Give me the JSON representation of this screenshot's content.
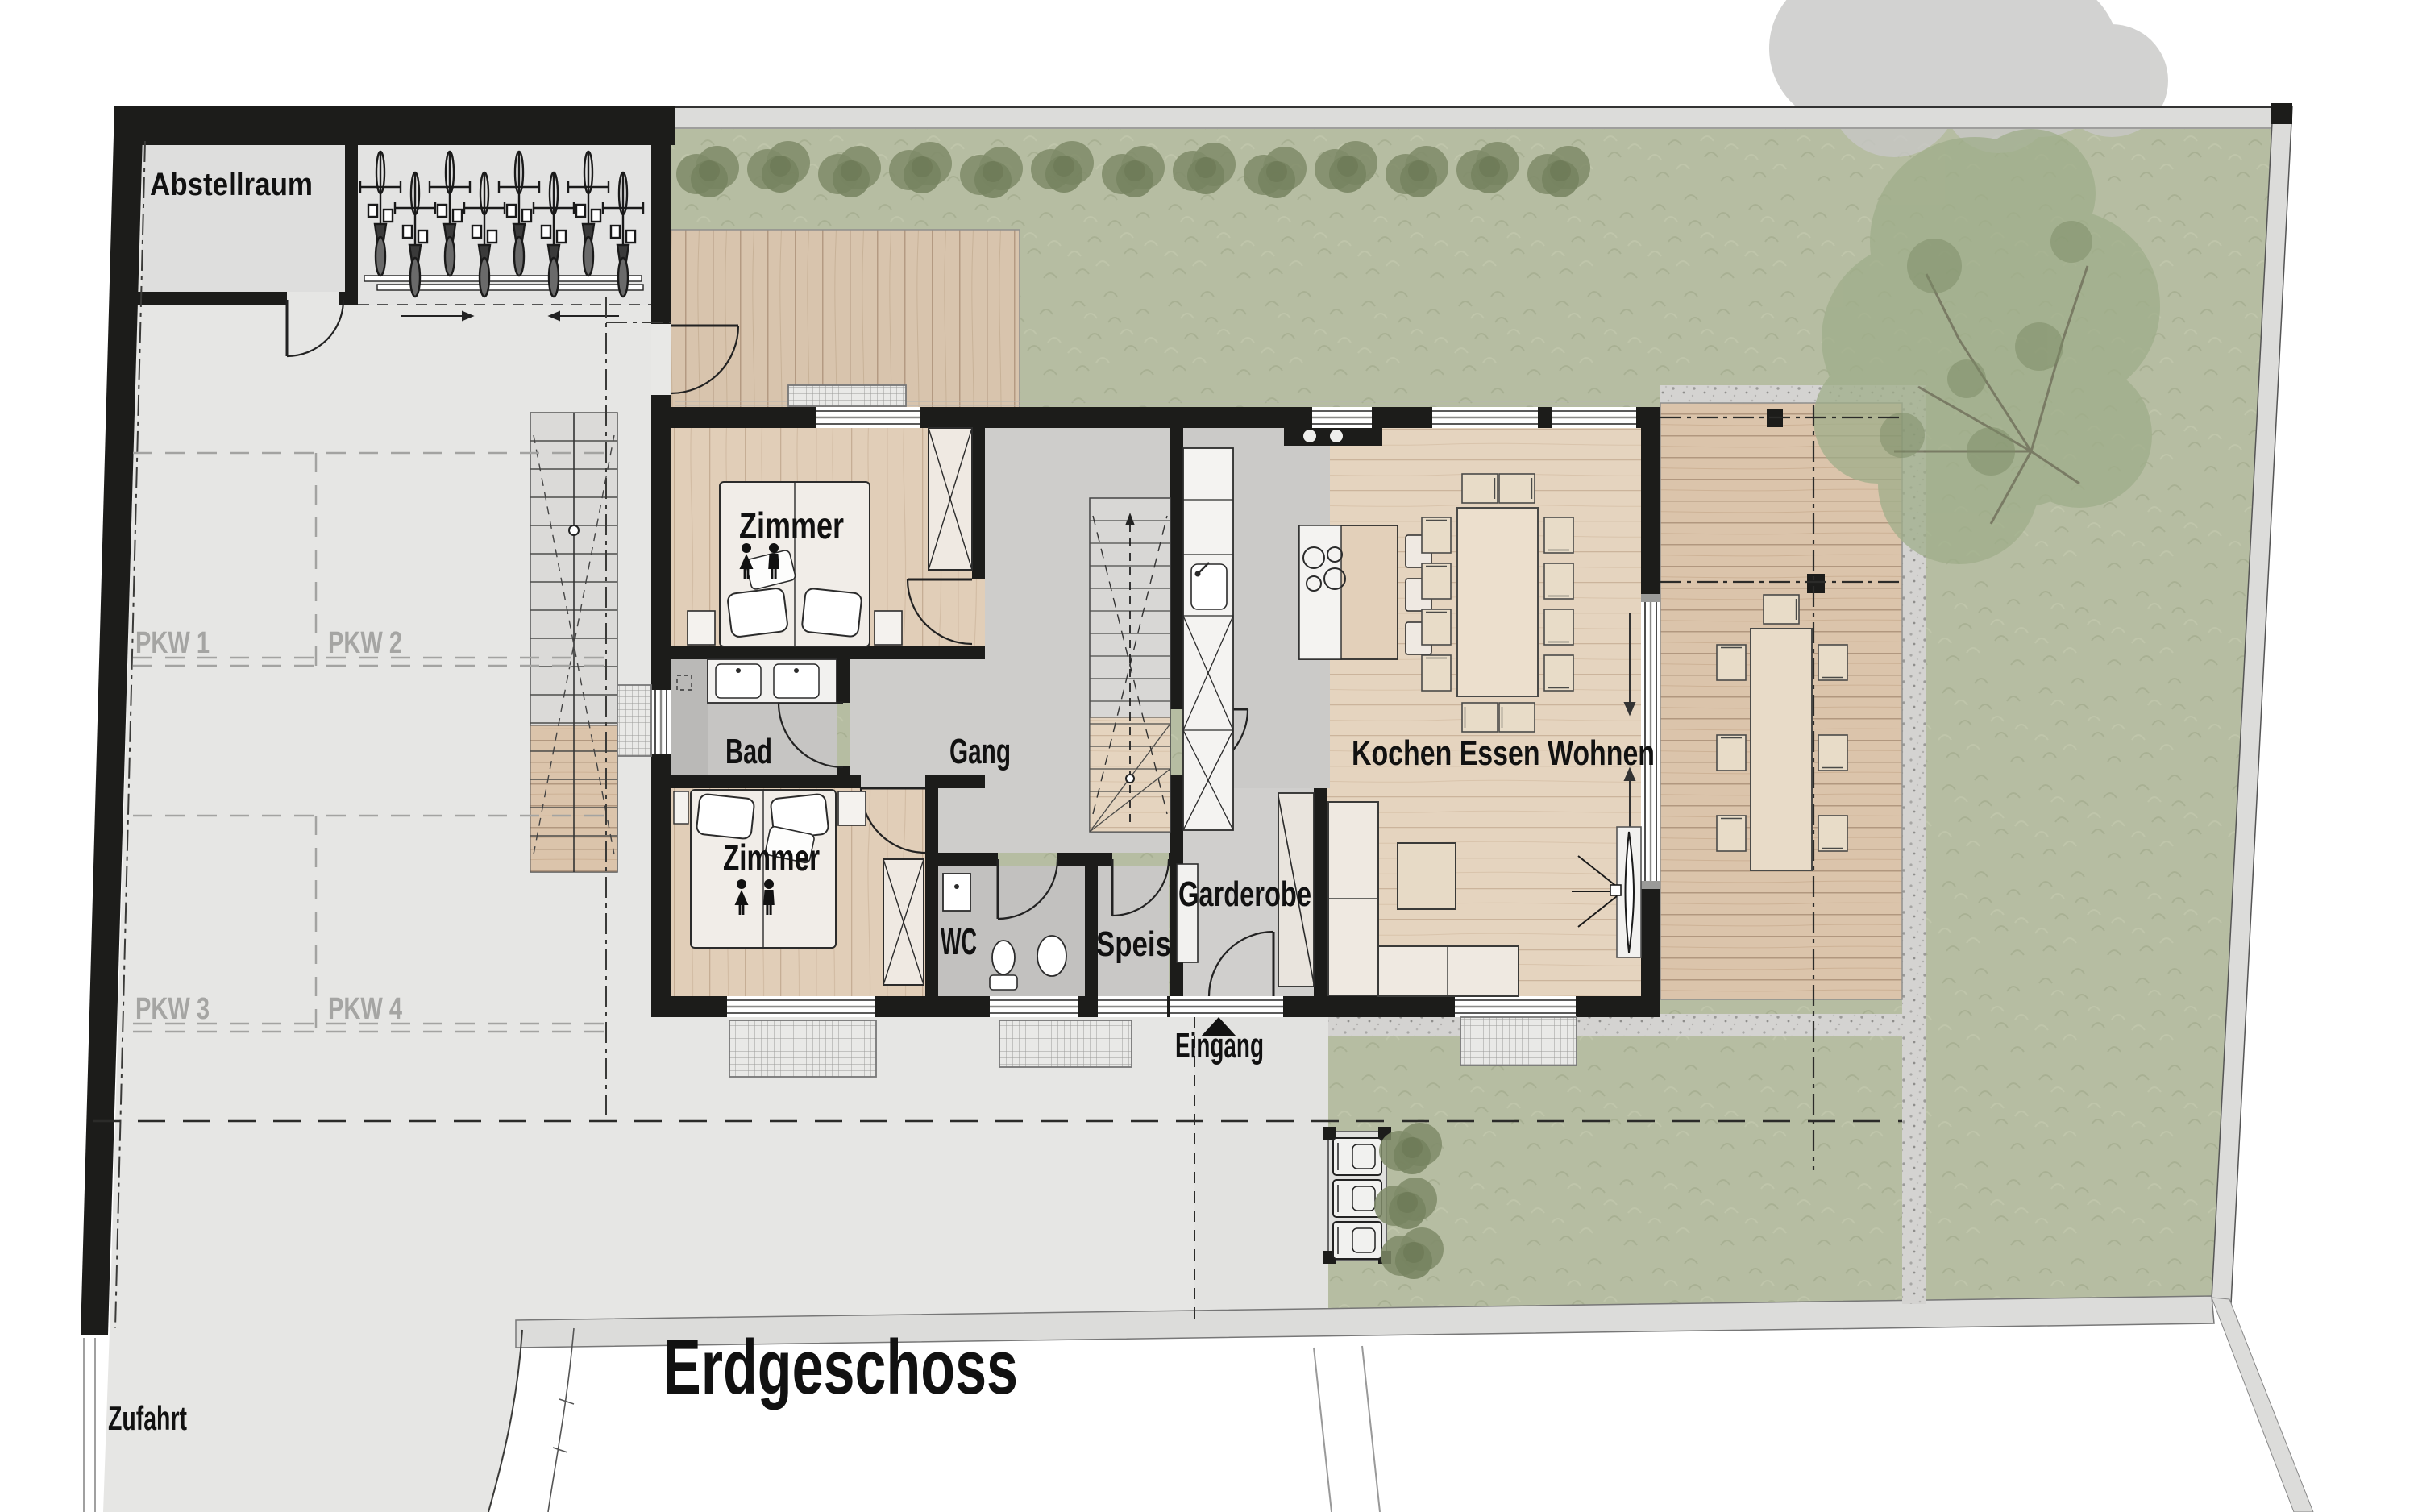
{
  "title": "Erdgeschoss",
  "rooms": {
    "abstellraum": "Abstellraum",
    "zimmer_1": "Zimmer",
    "zimmer_2": "Zimmer",
    "bad": "Bad",
    "gang": "Gang",
    "wc": "WC",
    "speis": "Speis",
    "garderobe": "Garderobe",
    "wohnen": "Kochen Essen Wohnen"
  },
  "site": {
    "eingang": "Eingang",
    "zufahrt": "Zufahrt",
    "parking": [
      "PKW 1",
      "PKW 2",
      "PKW 3",
      "PKW 4"
    ]
  },
  "colors": {
    "wall": "#1c1c1a",
    "grass": "#b6bda2",
    "paving": "#e6e6e4",
    "walkway": "#dcdcda",
    "interior_gray": "#cecdcb",
    "bad_gray": "#c6c5c3",
    "wc_gray": "#c2c1bf",
    "kitchen_gray": "#cbcac8",
    "wood_bedroom": "#e1ceb8",
    "wood_living": "#e5d4bf",
    "deck": "#d8c4ad",
    "terrace": "#dbc4ab",
    "gravel": "#d4d3d1",
    "furniture": "#efe9e1",
    "label_gray": "#a5a5a3",
    "hedge": "#7f8b68",
    "tree": "#9fae8a",
    "tree_outside": "#c8c8c6"
  }
}
